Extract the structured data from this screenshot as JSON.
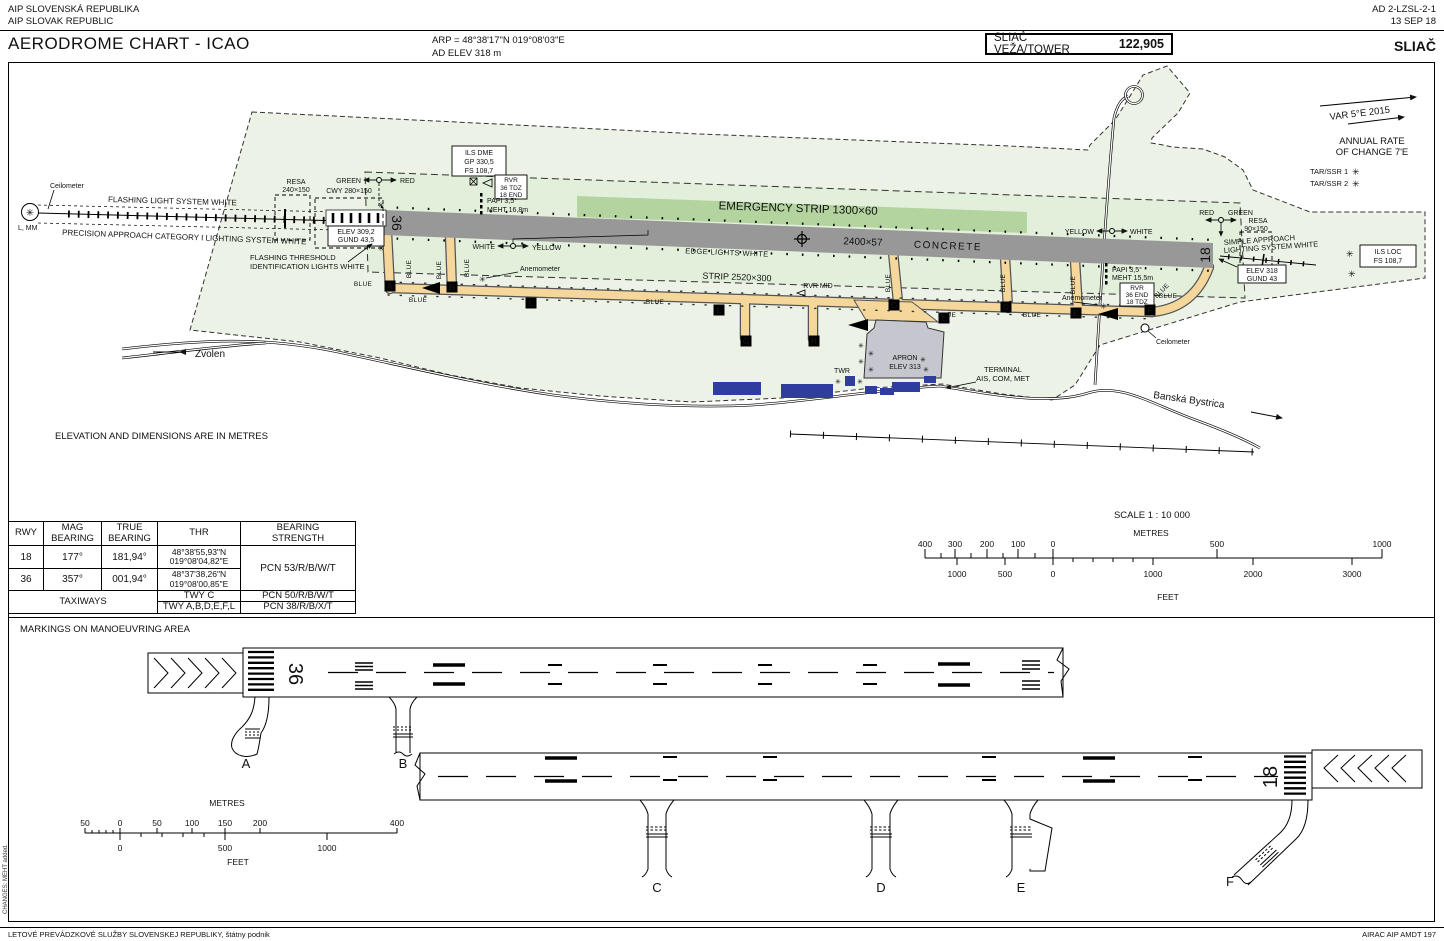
{
  "header": {
    "aip_l1": "AIP SLOVENSKÁ REPUBLIKA",
    "aip_l2": "AIP SLOVAK REPUBLIC",
    "doc_ref": "AD 2-LZSL-2-1",
    "doc_date": "13 SEP 18",
    "title": "AERODROME CHART - ICAO",
    "arp": "ARP = 48°38'17\"N   019°08'03\"E",
    "ad_elev": "AD ELEV 318 m",
    "tower_label": "SLIAČ VEŽA/TOWER",
    "tower_freq": "122,905",
    "airport_name": "SLIAČ"
  },
  "map": {
    "colors": {
      "boundary_fill": "#ecf3e6",
      "strip_fill": "#e2efdb",
      "emergency_fill": "#b3d49f",
      "runway_fill": "#989898",
      "taxiway_fill": "#f5d79c",
      "apron_fill": "#c6c6cf",
      "building_fill": "#2f3e9e"
    },
    "icons": {
      "star": "✳"
    },
    "labels": {
      "ceilometer": "Ceilometer",
      "flashing_light_system": "FLASHING LIGHT SYSTEM WHITE",
      "precision_approach": "PRECISION APPROACH CATEGORY I LIGHTING SYSTEM WHITE",
      "l_mm": "L, MM",
      "resa_left_1": "RESA",
      "resa_left_2": "240×150",
      "cwy": "CWY 280×150",
      "green": "GREEN",
      "red": "RED",
      "elev_36_1": "ELEV 309,2",
      "elev_36_2": "GUND 43,5",
      "flash_thr_1": "FLASHING THRESHOLD",
      "flash_thr_2": "IDENTIFICATION LIGHTS WHITE",
      "ils_dme_1": "ILS DME",
      "ils_dme_2": "GP 330,5",
      "ils_dme_3": "FS 108,7",
      "rvr": "RVR",
      "rvr_left_1": "36 TDZ",
      "rvr_left_2": "18 END",
      "papi": "PAPI 3,5°",
      "meht_36": "MEHT 16,8m",
      "white": "WHITE",
      "yellow": "YELLOW",
      "anemometer": "Anemometer",
      "emergency_strip": "EMERGENCY STRIP 1300×60",
      "rwy_dim": "2400×57",
      "concrete": "CONCRETE",
      "edge_lights": "EDGE LIGHTS WHITE",
      "strip_dim": "STRIP 2520×300",
      "rvr_mid": "RVR MID",
      "rwy_36": "36",
      "rwy_18": "18",
      "blue": "BLUE",
      "resa_right_1": "RESA",
      "resa_right_2": "90×150",
      "simple_app_1": "SIMPLE APPROACH",
      "simple_app_2": "LIGHTING SYSTEM WHITE",
      "elev_18_1": "ELEV 318",
      "elev_18_2": "GUND 43",
      "meht_18": "MEHT 15,5m",
      "rvr_right_1": "36 END",
      "rvr_right_2": "18 TDZ",
      "ils_loc_1": "ILS LOC",
      "ils_loc_2": "FS 108,7",
      "tar_ssr_1": "TAR/SSR 1",
      "tar_ssr_2": "TAR/SSR 2",
      "var": "VAR 5°E 2015",
      "annual_1": "ANNUAL RATE",
      "annual_2": "OF CHANGE 7'E",
      "zvolen": "Zvolen",
      "banska": "Banská Bystrica",
      "apron_1": "APRON",
      "apron_2": "ELEV 313",
      "twr": "TWR",
      "terminal_1": "TERMINAL",
      "terminal_2": "AIS, COM, MET",
      "elevation_note": "ELEVATION AND DIMENSIONS ARE IN METRES",
      "twy_a": "A",
      "twy_b": "B",
      "twy_c": "C",
      "twy_d": "D",
      "twy_e": "E",
      "twy_f": "F",
      "twy_g": "G",
      "twy_h": "H",
      "twy_l": "L"
    }
  },
  "table": {
    "h_rwy": "RWY",
    "h_mag_1": "MAG",
    "h_mag_2": "BEARING",
    "h_true_1": "TRUE",
    "h_true_2": "BEARING",
    "h_thr": "THR",
    "h_bs_1": "BEARING",
    "h_bs_2": "STRENGTH",
    "r18": {
      "rwy": "18",
      "mag": "177°",
      "true": "181,94°",
      "thr_lat": "48°38'55,93\"N",
      "thr_lon": "019°08'04,82\"E"
    },
    "r36": {
      "rwy": "36",
      "mag": "357°",
      "true": "001,94°",
      "thr_lat": "48°37'38,26\"N",
      "thr_lon": "019°08'00,85\"E"
    },
    "pcn_rwy": "PCN 53/R/B/W/T",
    "taxiways": "TAXIWAYS",
    "twy_c": "TWY C",
    "pcn_c": "PCN 50/R/B/W/T",
    "twy_rest": "TWY A,B,D,E,F,L",
    "pcn_rest": "PCN 38/R/B/X/T"
  },
  "scale1": {
    "title": "SCALE 1 : 10 000",
    "metres": "METRES",
    "feet": "FEET",
    "m": [
      "400",
      "300",
      "200",
      "100",
      "0",
      "500",
      "1000"
    ],
    "f": [
      "1000",
      "500",
      "0",
      "1000",
      "2000",
      "3000"
    ]
  },
  "markings": {
    "title": "MARKINGS ON MANOEUVRING AREA",
    "rwy_36": "36",
    "rwy_18": "18",
    "a": "A",
    "b": "B",
    "c": "C",
    "d": "D",
    "e": "E",
    "f": "F",
    "scale2": {
      "metres": "METRES",
      "feet": "FEET",
      "m": [
        "50",
        "0",
        "50",
        "100",
        "150",
        "200",
        "400"
      ],
      "f": [
        "0",
        "500",
        "1000"
      ]
    }
  },
  "footer": {
    "left": "LETOVÉ PREVÁDZKOVÉ SLUŽBY SLOVENSKEJ REPUBLIKY, štátny podnik",
    "right": "AIRAC AIP AMDT 197",
    "changes": "CHANGES: MEHT added."
  }
}
